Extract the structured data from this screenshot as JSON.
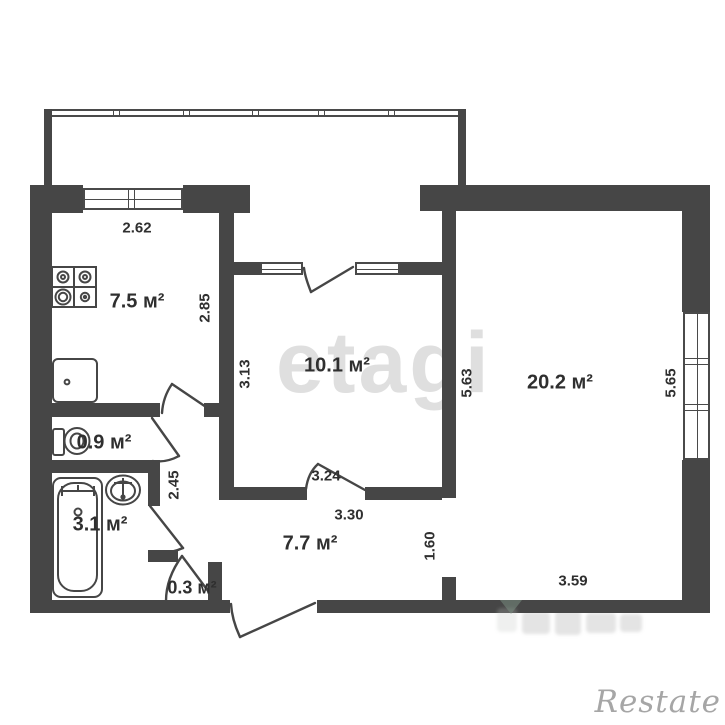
{
  "plan": {
    "type": "apartment-floor-plan",
    "wall_color": "#464646",
    "text_color": "#2f2f2f",
    "rooms": [
      {
        "id": "kitchen",
        "area_label": "7.5 м²"
      },
      {
        "id": "bedroom",
        "area_label": "10.1 м²"
      },
      {
        "id": "living-room",
        "area_label": "20.2 м²"
      },
      {
        "id": "wc",
        "area_label": "0.9 м²"
      },
      {
        "id": "bathroom",
        "area_label": "3.1 м²"
      },
      {
        "id": "hallway",
        "area_label": "7.7 м²"
      },
      {
        "id": "closet",
        "area_label": "0.3 м²"
      }
    ],
    "dimensions": [
      {
        "text": "2.62",
        "orientation": "horizontal"
      },
      {
        "text": "2.85",
        "orientation": "vertical"
      },
      {
        "text": "3.13",
        "orientation": "vertical"
      },
      {
        "text": "5.63",
        "orientation": "vertical"
      },
      {
        "text": "5.65",
        "orientation": "vertical"
      },
      {
        "text": "3.24",
        "orientation": "horizontal"
      },
      {
        "text": "3.30",
        "orientation": "horizontal"
      },
      {
        "text": "2.45",
        "orientation": "vertical"
      },
      {
        "text": "1.60",
        "orientational": "vertical"
      },
      {
        "text": "3.59",
        "orientation": "horizontal"
      }
    ],
    "fixtures": [
      "stove-icon",
      "kitchen-sink-icon",
      "toilet-icon",
      "bathtub-icon",
      "washbasin-icon"
    ],
    "watermarks": {
      "center": "etagi",
      "bottom_right": "Restate",
      "watermark_color": "#a6a6a6"
    }
  }
}
